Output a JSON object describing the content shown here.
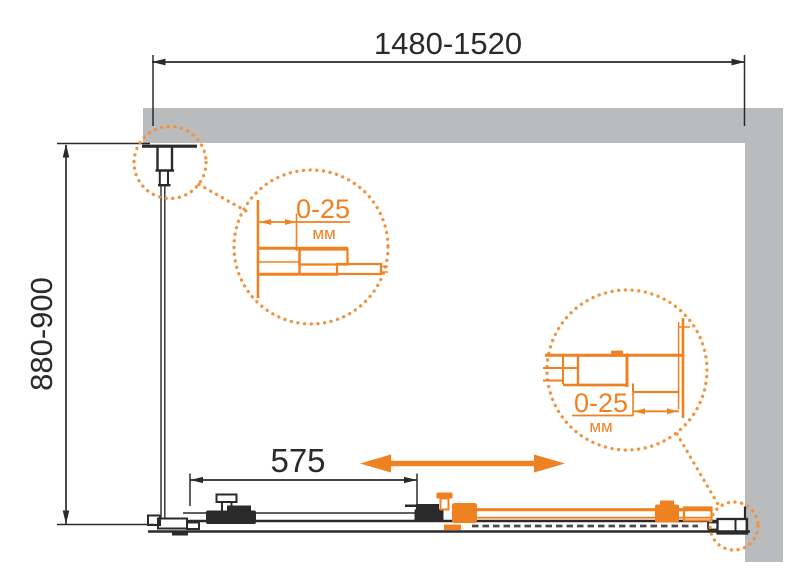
{
  "dimensions": {
    "width_range": "1480-1520",
    "height_range": "880-900",
    "door_width": "575"
  },
  "details": {
    "left": {
      "value": "0-25",
      "unit": "мм"
    },
    "right": {
      "value": "0-25",
      "unit": "мм"
    }
  },
  "colors": {
    "accent_orange": "#F08121",
    "line_black": "#2A2A2C",
    "wall_gray": "#B9BBBD"
  }
}
